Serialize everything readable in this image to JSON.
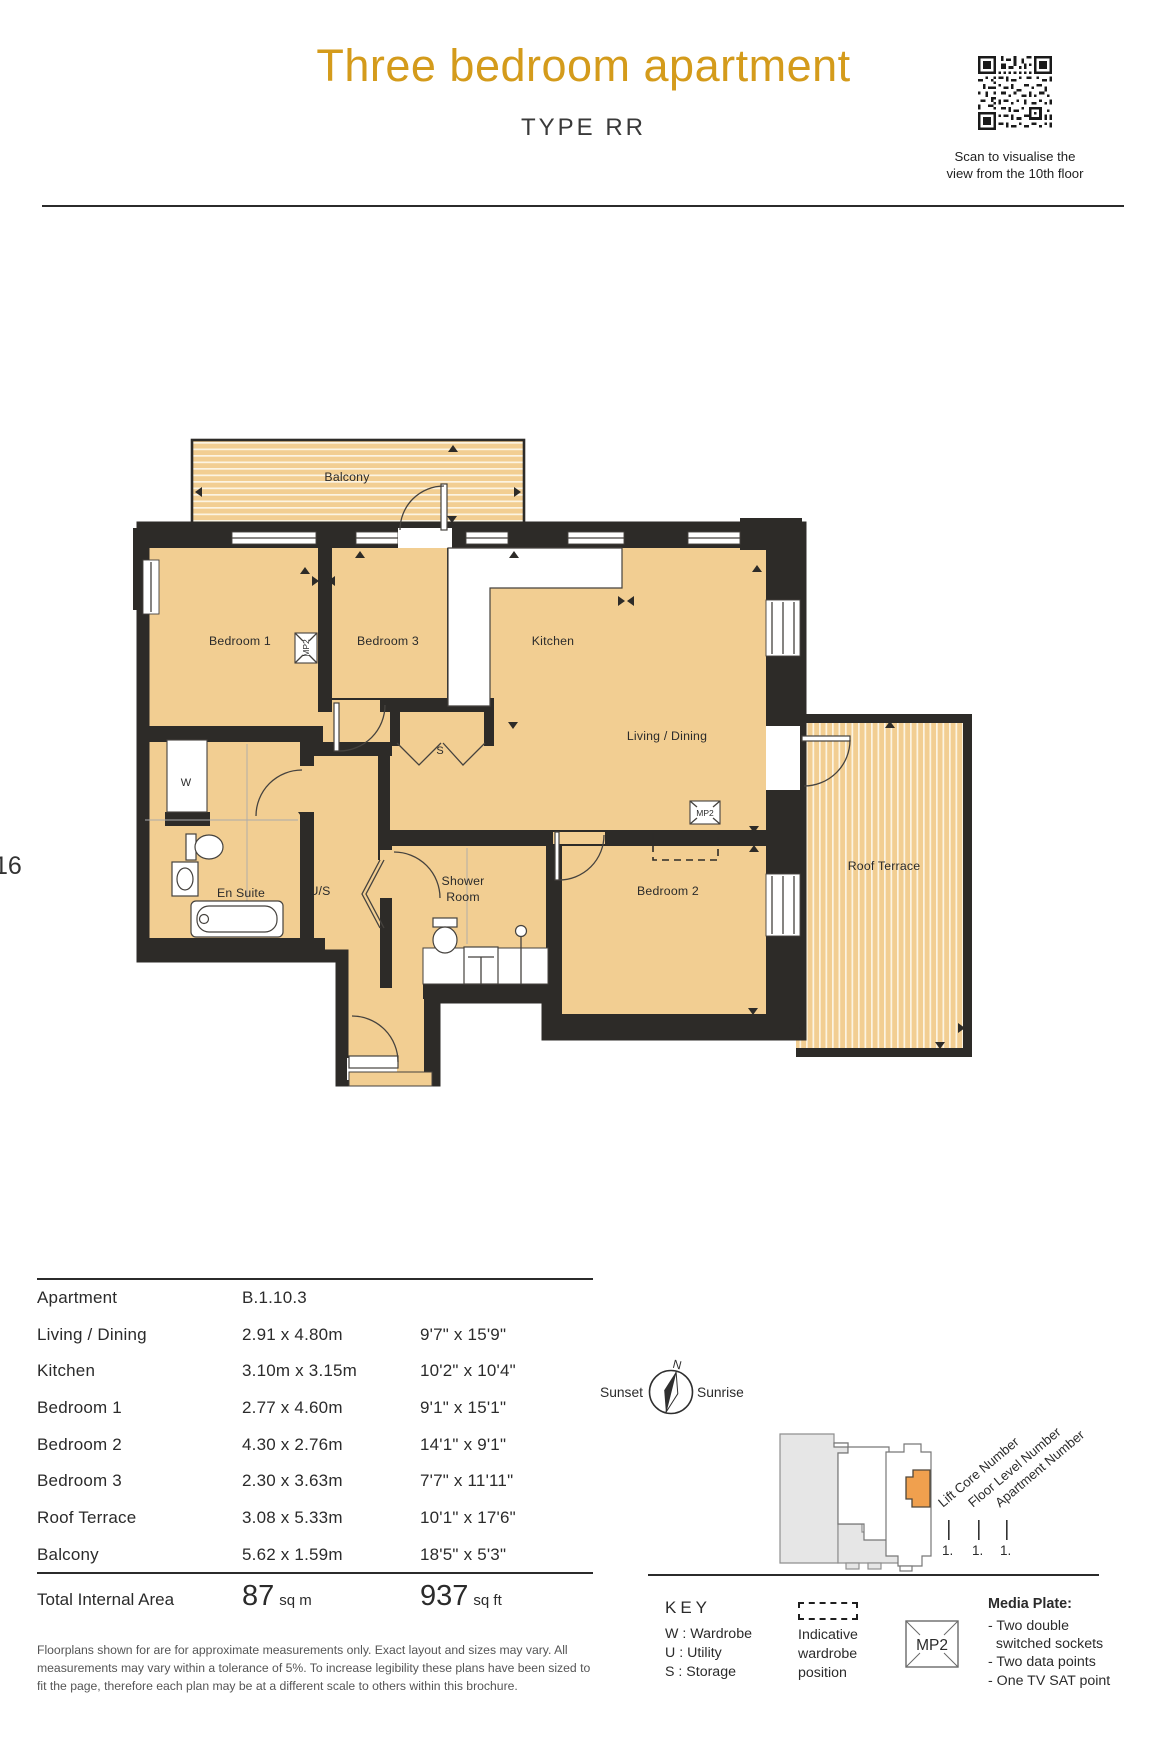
{
  "page": {
    "number": "16"
  },
  "header": {
    "title": "Three bedroom apartment",
    "subtitle": "TYPE RR",
    "qr_caption": "Scan to visualise the\nview from the 10th floor"
  },
  "plan": {
    "rooms": {
      "balcony": "Balcony",
      "bedroom1": "Bedroom 1",
      "bedroom3": "Bedroom 3",
      "kitchen": "Kitchen",
      "living": "Living / Dining",
      "bedroom2": "Bedroom 2",
      "roof_terrace": "Roof Terrace",
      "ensuite": "En Suite",
      "utility": "U/S",
      "shower_line1": "Shower",
      "shower_line2": "Room",
      "wardrobe": "W",
      "storage": "S",
      "media_plate": "MP2"
    }
  },
  "table": {
    "rows": [
      {
        "label": "Apartment",
        "metric": "B.1.10.3",
        "imperial": ""
      },
      {
        "label": "Living / Dining",
        "metric": "2.91 x 4.80m",
        "imperial": "9'7\" x 15'9\""
      },
      {
        "label": "Kitchen",
        "metric": "3.10m x 3.15m",
        "imperial": "10'2\" x 10'4\""
      },
      {
        "label": "Bedroom 1",
        "metric": "2.77 x 4.60m",
        "imperial": "9'1\" x 15'1\""
      },
      {
        "label": "Bedroom 2",
        "metric": "4.30 x 2.76m",
        "imperial": "14'1\" x 9'1\""
      },
      {
        "label": "Bedroom 3",
        "metric": "2.30 x 3.63m",
        "imperial": "7'7\" x 11'11\""
      },
      {
        "label": "Roof Terrace",
        "metric": "3.08 x 5.33m",
        "imperial": "10'1\" x 17'6\""
      },
      {
        "label": "Balcony",
        "metric": "5.62 x 1.59m",
        "imperial": "18'5\" x 5'3\""
      }
    ],
    "total": {
      "label": "Total Internal Area",
      "metric_value": "87",
      "metric_unit": "sq m",
      "imperial_value": "937",
      "imperial_unit": "sq ft"
    },
    "disclaimer": "Floorplans shown for are for approximate measurements only. Exact layout and sizes may vary. All\nmeasurements may vary within a tolerance of 5%. To increase legibility these plans have been sized to\nfit the page, therefore each plan may be at a different scale to others within this brochure."
  },
  "compass": {
    "north": "N",
    "west": "Sunset",
    "east": "Sunrise"
  },
  "locator": {
    "labels": [
      "Lift Core Number",
      "Floor Level Number",
      "Apartment Number"
    ],
    "values": [
      "1.",
      "1.",
      "1."
    ]
  },
  "key": {
    "title": "KEY",
    "items": {
      "w": "W : Wardrobe",
      "u": "U : Utility",
      "s": "S : Storage"
    },
    "wardrobe_note": "Indicative\nwardrobe\nposition",
    "mp2": "MP2",
    "media_plate_title": "Media Plate:",
    "media_plate_items": "- Two double\n  switched sockets\n- Two data points\n- One TV SAT point"
  },
  "colors": {
    "accent_gold": "#D49B1B",
    "floor_tan": "#F2CE92",
    "wall_dark": "#2D2B28",
    "unit_orange": "#F0A04E"
  }
}
